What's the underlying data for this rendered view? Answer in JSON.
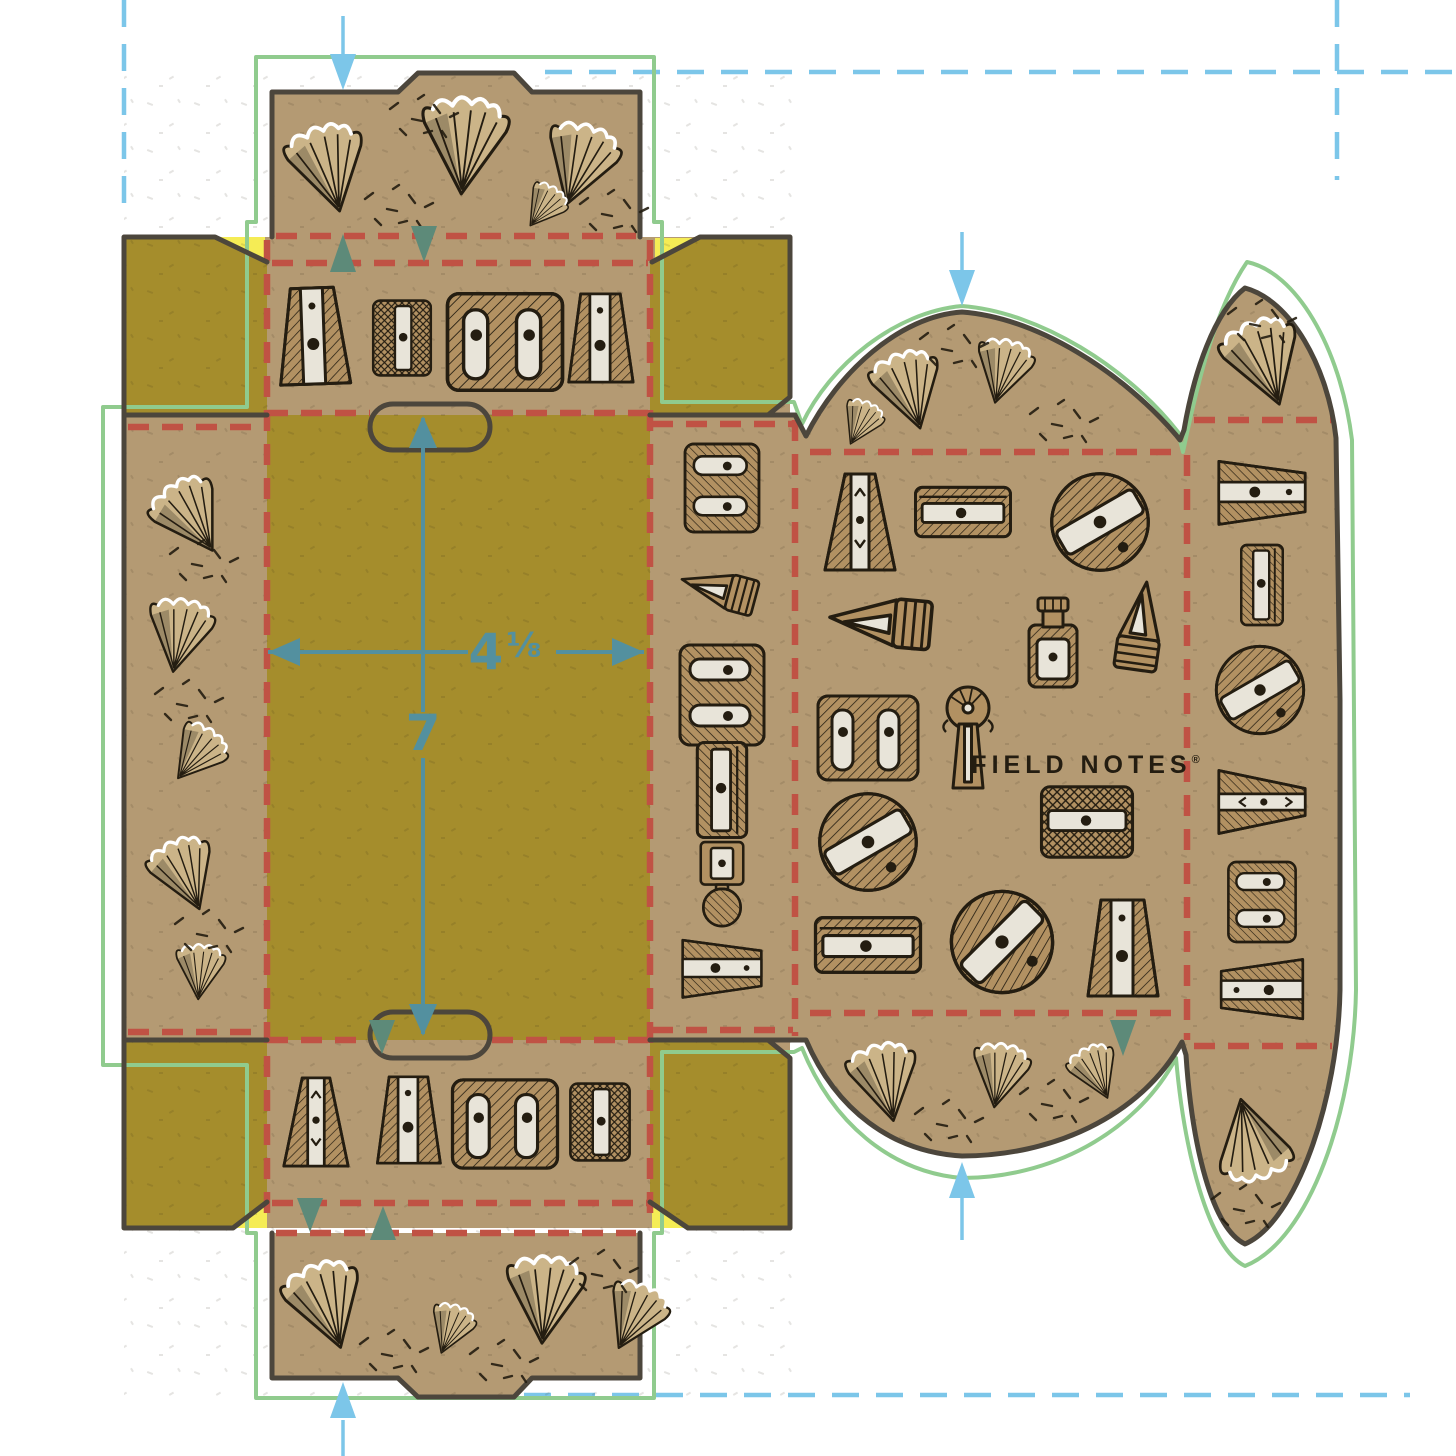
{
  "document": {
    "type": "packaging-dieline-artwork",
    "description": "Flat die-line template of a Field Notes pencil-sharpener box printed on kraft board, shown on a white artboard with guides"
  },
  "brand": {
    "label": "FIELD NOTES",
    "registered_mark": "®"
  },
  "dimension_annotations": {
    "width": {
      "whole": "4",
      "fraction": "⅛",
      "combined": "4 1/8"
    },
    "height": {
      "value": "7"
    }
  },
  "colors": {
    "bg": "#ffffff",
    "kraft": "#b49a73",
    "olive": "#a58d2c",
    "yellow_highlight": "#f5ec55",
    "crease_red": "#c05244",
    "dieline_green": "#90cb8e",
    "guide_blue": "#7cc6e9",
    "dimension_teal": "#53909f",
    "fold_arrow_teal": "#5d8a79",
    "outline_dark": "#4c463c",
    "ink": "#241d11",
    "sharpener_tan": "#b29162",
    "silver": "#e8e4d9",
    "shaving_beige": "#cbb488"
  },
  "panels": [
    {
      "name": "top-tuck-flap",
      "artwork": "pencil-shavings"
    },
    {
      "name": "front-top-panel",
      "artwork": "four-pencil-sharpeners"
    },
    {
      "name": "left-dust-flap-top",
      "artwork": "solid-olive"
    },
    {
      "name": "right-dust-flap-top",
      "artwork": "solid-olive"
    },
    {
      "name": "left-shavings-flap",
      "artwork": "pencil-shavings"
    },
    {
      "name": "main-olive-panel",
      "artwork": "solid-olive-with-dimensions"
    },
    {
      "name": "spine-panel",
      "artwork": "six-rotated-pencil-sharpeners"
    },
    {
      "name": "front-bottom-panel",
      "artwork": "four-pencil-sharpeners"
    },
    {
      "name": "left-dust-flap-bottom",
      "artwork": "solid-olive"
    },
    {
      "name": "right-dust-flap-bottom",
      "artwork": "solid-olive"
    },
    {
      "name": "bottom-tuck-flap",
      "artwork": "pencil-shavings"
    },
    {
      "name": "back-wrap-panel",
      "artwork": "pencil-sharpener-collection-with-logo"
    },
    {
      "name": "right-end-flap",
      "artwork": "rotated-pencil-sharpeners-and-shavings"
    }
  ],
  "markings": {
    "crease_lines": "red-dashed",
    "die_cut_outline": "green-solid",
    "artboard_guides": "light-blue-dashed",
    "fold_direction_arrows": "teal-triangles",
    "thumb_slots": 2
  }
}
